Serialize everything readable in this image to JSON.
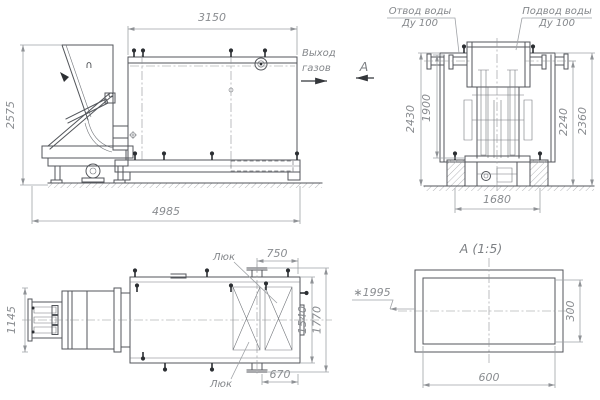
{
  "drawing": {
    "side_view": {
      "dim_tank_length": "3150",
      "dim_overall_height": "2575",
      "dim_overall_length": "4985",
      "gas_outlet_line1": "Выход",
      "gas_outlet_line2": "газов",
      "view_arrow_label": "А",
      "hopper_mark": "∩"
    },
    "end_view": {
      "water_outlet_line1": "Отвод воды",
      "water_outlet_line2": "Ду 100",
      "water_inlet_line1": "Подвод воды",
      "water_inlet_line2": "Ду 100",
      "dim_outer_left": "2430",
      "dim_inner_left": "1900",
      "dim_inner_right": "2240",
      "dim_outer_right": "2360",
      "dim_foundation_span": "1680"
    },
    "top_view": {
      "hatch_label_top": "Люк",
      "hatch_label_bottom": "Люк",
      "dim_hatch_top": "750",
      "dim_feeder_width": "1145",
      "dim_body_width": "1540",
      "dim_overall_width": "1770",
      "dim_hatch_bottom": "670"
    },
    "detail_view": {
      "title": "А (1:5)",
      "dim_reference": "∗1995",
      "dim_height": "300",
      "dim_width": "600"
    },
    "colors": {
      "object_line": "#53565b",
      "dimension_line": "#9fa2a6",
      "dimension_text": "#898c90",
      "dark_fitting": "#2c2f33",
      "background": "#ffffff"
    }
  }
}
